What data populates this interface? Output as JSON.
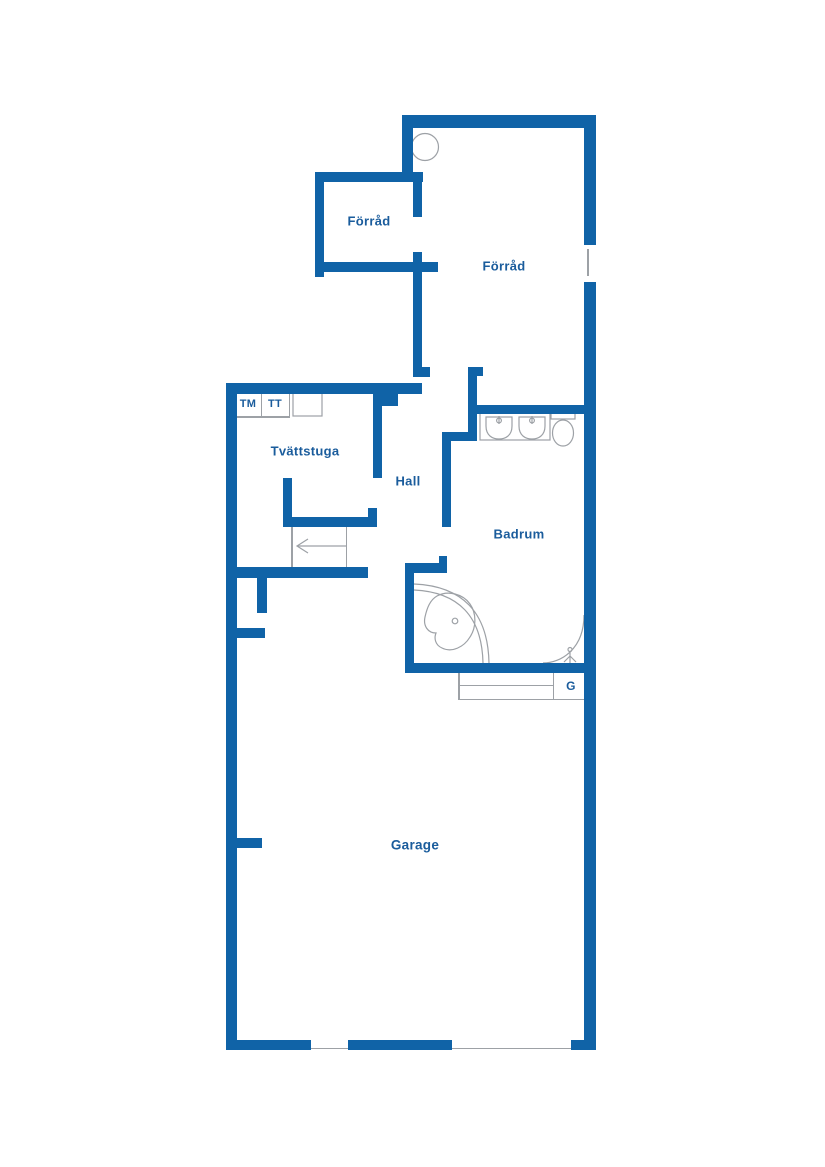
{
  "plan": {
    "title": "floor-plan",
    "wall_color": "#1063a7",
    "label_color": "#1a5c9c",
    "thin_color": "#9da1a6",
    "background": "#ffffff",
    "labels": [
      {
        "name": "room-label-forrad-small",
        "text": "Förråd",
        "x": 369,
        "y": 221,
        "size": 13
      },
      {
        "name": "room-label-forrad-large",
        "text": "Förråd",
        "x": 504,
        "y": 266,
        "size": 13
      },
      {
        "name": "appliance-label-tm",
        "text": "TM",
        "x": 248,
        "y": 404,
        "size": 11
      },
      {
        "name": "appliance-label-tt",
        "text": "TT",
        "x": 275,
        "y": 404,
        "size": 11
      },
      {
        "name": "room-label-tvattstuga",
        "text": "Tvättstuga",
        "x": 305,
        "y": 451,
        "size": 13
      },
      {
        "name": "room-label-hall",
        "text": "Hall",
        "x": 408,
        "y": 481,
        "size": 13
      },
      {
        "name": "room-label-badrum",
        "text": "Badrum",
        "x": 519,
        "y": 534,
        "size": 13
      },
      {
        "name": "closet-label-g",
        "text": "G",
        "x": 571,
        "y": 686,
        "size": 12
      },
      {
        "name": "room-label-garage",
        "text": "Garage",
        "x": 415,
        "y": 845,
        "size": 13.5
      }
    ],
    "walls": [
      [
        402,
        115,
        194,
        13
      ],
      [
        584,
        115,
        12,
        130
      ],
      [
        584,
        282,
        12,
        768
      ],
      [
        571,
        1040,
        25,
        10
      ],
      [
        348,
        1040,
        104,
        10
      ],
      [
        226,
        1040,
        85,
        10
      ],
      [
        226,
        383,
        11,
        667
      ],
      [
        402,
        115,
        11,
        67
      ],
      [
        315,
        172,
        108,
        10
      ],
      [
        315,
        172,
        9,
        105
      ],
      [
        315,
        262,
        123,
        10
      ],
      [
        413,
        172,
        9,
        45
      ],
      [
        413,
        252,
        9,
        125
      ],
      [
        413,
        367,
        17,
        10
      ],
      [
        468,
        367,
        15,
        9
      ],
      [
        468,
        374,
        9,
        60
      ],
      [
        442,
        432,
        35,
        9
      ],
      [
        442,
        432,
        9,
        95
      ],
      [
        477,
        405,
        108,
        9
      ],
      [
        226,
        383,
        196,
        11
      ],
      [
        373,
        394,
        25,
        12
      ],
      [
        373,
        406,
        9,
        72
      ],
      [
        283,
        478,
        9,
        40
      ],
      [
        283,
        517,
        94,
        10
      ],
      [
        368,
        508,
        9,
        9
      ],
      [
        226,
        567,
        142,
        11
      ],
      [
        257,
        578,
        10,
        35
      ],
      [
        237,
        628,
        28,
        10
      ],
      [
        237,
        838,
        25,
        10
      ],
      [
        405,
        563,
        9,
        110
      ],
      [
        405,
        563,
        40,
        10
      ],
      [
        439,
        556,
        8,
        17
      ],
      [
        405,
        663,
        191,
        10
      ]
    ],
    "thin_lines": [
      [
        237,
        416,
        53,
        1.5
      ],
      [
        260.5,
        394,
        1.5,
        22
      ],
      [
        288.5,
        394,
        1.5,
        22
      ],
      [
        291,
        527,
        1.5,
        40
      ],
      [
        345.5,
        527,
        1.5,
        40
      ],
      [
        458,
        673,
        1.5,
        27
      ],
      [
        458,
        698.5,
        127,
        1.5
      ],
      [
        552.5,
        673,
        1.5,
        26
      ],
      [
        458,
        684.5,
        95,
        1.5
      ],
      [
        587,
        249,
        1.5,
        27
      ],
      [
        231,
        1047.5,
        362,
        1.5
      ]
    ],
    "fixture_rects": [
      {
        "name": "vanity-counter",
        "x": 480,
        "y": 413,
        "w": 70,
        "h": 27
      },
      {
        "name": "laundry-appliance-box",
        "x": 293,
        "y": 393,
        "w": 29,
        "h": 23
      },
      {
        "name": "toilet-tank",
        "x": 551,
        "y": 410,
        "w": 24,
        "h": 9
      }
    ],
    "fixture_ellipses": [
      {
        "name": "toilet-bowl",
        "cx": 563,
        "cy": 433,
        "rx": 10.5,
        "ry": 13
      }
    ],
    "fixture_circles": [
      {
        "name": "floor-drain",
        "cx": 425,
        "cy": 147,
        "r": 13.5
      },
      {
        "name": "bathtub-drain",
        "cx": 455,
        "cy": 621,
        "r": 2.8
      },
      {
        "name": "sink-faucet-left",
        "cx": 499,
        "cy": 420.5,
        "r": 2.4
      },
      {
        "name": "sink-faucet-right",
        "cx": 532,
        "cy": 420.5,
        "r": 2.4
      },
      {
        "name": "shower-head",
        "cx": 570,
        "cy": 649.5,
        "r": 2
      }
    ],
    "fixture_paths": [
      {
        "name": "bathtub-outer-rim",
        "d": "M414,584 C462,586 488,612 489,663"
      },
      {
        "name": "bathtub-inner-rim",
        "d": "M414,590 C458,592 482,616 483,663"
      },
      {
        "name": "bathtub-basin",
        "d": "M437,596 C448,590 463,594 470,604 C477,614 476,628 470,637 C464,647 452,653 442,648 C435,645 434,638 436,633 C428,633 423,626 425,617 C427,608 430,600 437,596 Z"
      },
      {
        "name": "sink-bowl-left",
        "d": "M486,417 L512,417 L512,426 C512,436 505,439 499,439 C493,439 486,436 486,426 Z"
      },
      {
        "name": "sink-bowl-right",
        "d": "M519,417 L545,417 L545,426 C545,436 538,439 532,439 C526,439 519,436 519,426 Z"
      },
      {
        "name": "sink-faucet-left-stem",
        "d": "M499,416 L499,424"
      },
      {
        "name": "sink-faucet-right-stem",
        "d": "M532,416 L532,424"
      },
      {
        "name": "shower-enclosure",
        "d": "M584,615 C584,650 560,663 543,663"
      },
      {
        "name": "shower-head-stem",
        "d": "M570,652 L570,656 M570,656 L564,662 M570,656 L570,663 M570,656 L576,662"
      },
      {
        "name": "stairs-arrow-shaft",
        "d": "M346,546 L298,546"
      },
      {
        "name": "stairs-arrow-head",
        "d": "M308,539 L297,546 L308,553"
      }
    ]
  }
}
